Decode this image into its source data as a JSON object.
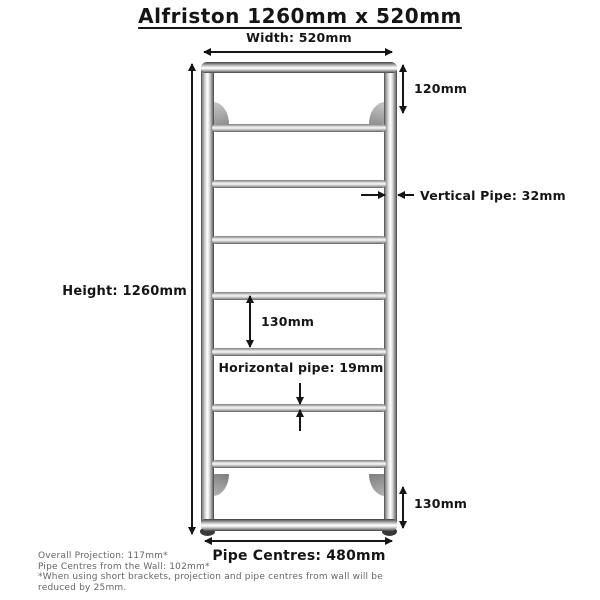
{
  "title": "Alfriston 1260mm x 520mm",
  "colors": {
    "ink": "#151515",
    "footer_text": "#666666",
    "chrome_light": "#f5f5f5",
    "chrome_dark": "#4a4a4a"
  },
  "dimensions": {
    "width_label": "Width: 520mm",
    "height_label": "Height: 1260mm",
    "top_gap_label": "120mm",
    "vertical_pipe_label": "Vertical Pipe: 32mm",
    "rung_spacing_label": "130mm",
    "horizontal_pipe_label": "Horizontal pipe: 19mm",
    "bottom_gap_label": "130mm",
    "pipe_centres_label": "Pipe Centres: 480mm"
  },
  "footer": {
    "line1": "Overall Projection: 117mm*",
    "line2": "Pipe Centres from the Wall: 102mm*",
    "note": "*When using short brackets, projection and pipe centres from wall will be reduced by 25mm."
  }
}
